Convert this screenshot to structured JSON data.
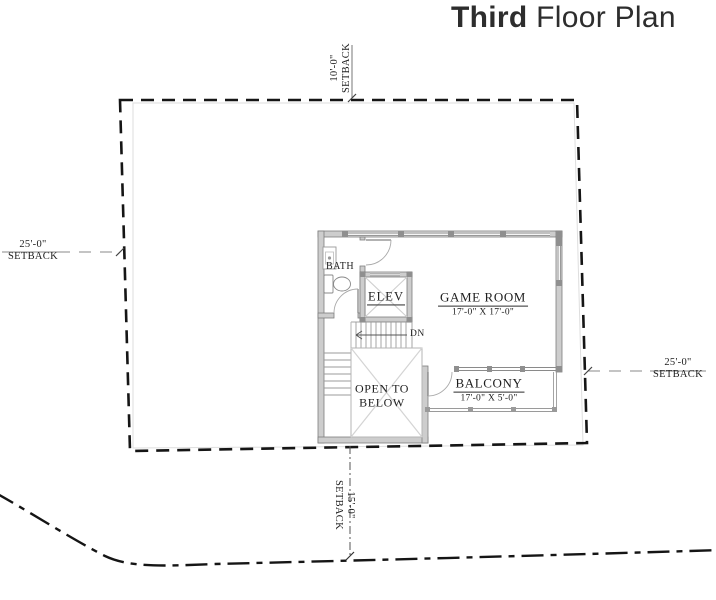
{
  "title": {
    "primary": "Third",
    "secondary": " Floor Plan"
  },
  "setbacks": {
    "top": {
      "dimension": "10'-0\"",
      "label": "SETBACK"
    },
    "left": {
      "dimension": "25'-0\"",
      "label": "SETBACK"
    },
    "right": {
      "dimension": "25'-0\"",
      "label": "SETBACK"
    },
    "bottom": {
      "dimension": "15'-0\"",
      "label": "SETBACK"
    }
  },
  "rooms": {
    "game_room": {
      "name": "GAME ROOM",
      "dimensions": "17'-0\" X 17'-0\""
    },
    "balcony": {
      "name": "BALCONY",
      "dimensions": "17'-0\" X 5'-0\""
    },
    "open_to_below": {
      "line1": "OPEN TO",
      "line2": "BELOW"
    },
    "elevator": {
      "name": "ELEV"
    },
    "bath": {
      "name": "BATH"
    },
    "stair": {
      "direction_label": "DN"
    }
  },
  "colors": {
    "wall_fill": "#cdcdcd",
    "wall_stroke": "#7e7e7e",
    "boundary_line": "#151515",
    "label_text": "#1e1e1e"
  }
}
